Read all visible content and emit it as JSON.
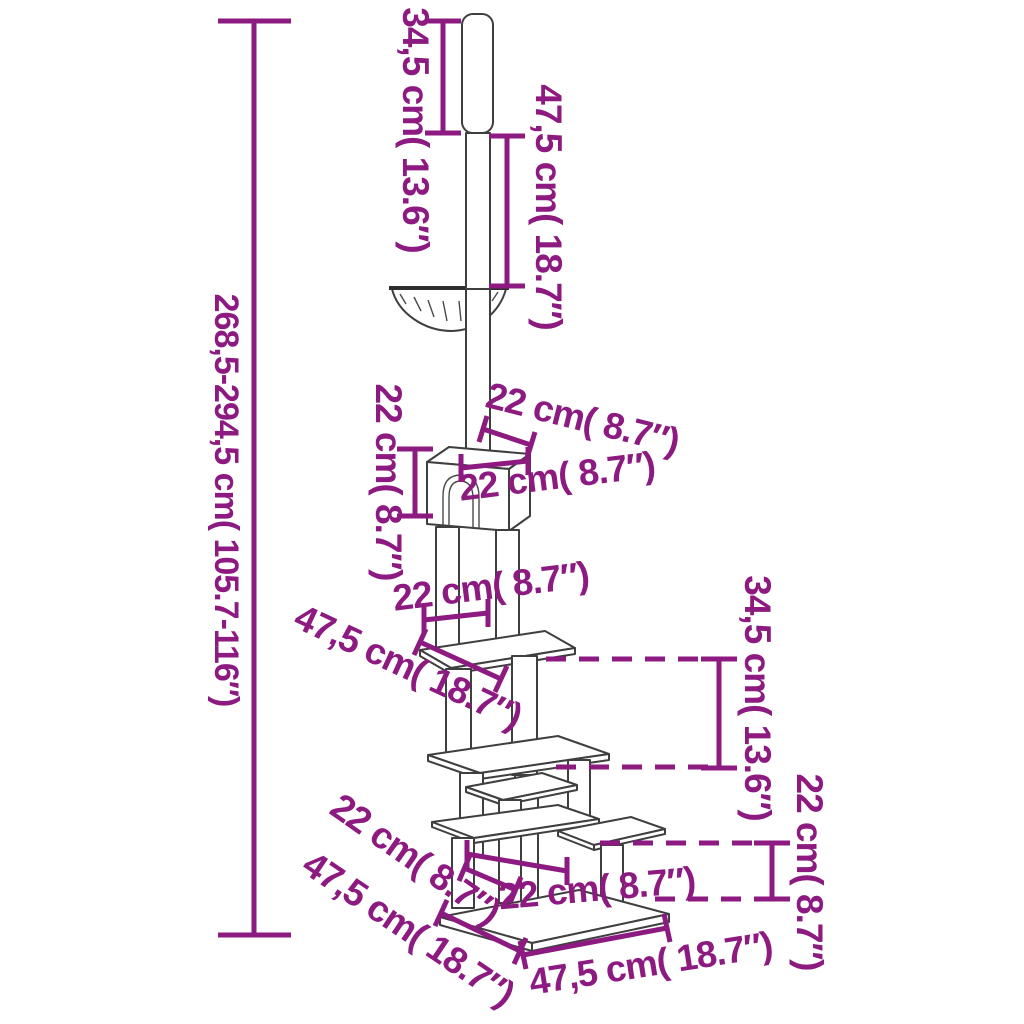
{
  "diagram": {
    "product": "floor-to-ceiling-cat-tree",
    "style": {
      "dimension_color": "#8d1a80",
      "outline_color": "#3f3f3f",
      "background": "#ffffff"
    },
    "dimensions": {
      "overall_height": {
        "text": "268,5-294,5 cm( 105.7-116″)",
        "cm": "268,5-294,5",
        "inches": "105.7-116"
      },
      "ceiling_tube_height": {
        "text": "34,5 cm( 13.6″)",
        "cm": "34,5",
        "inches": "13.6"
      },
      "upper_pole_height": {
        "text": "47,5 cm( 18.7″)",
        "cm": "47,5",
        "inches": "18.7"
      },
      "house_height": {
        "text": "22 cm( 8.7″)",
        "cm": "22",
        "inches": "8.7"
      },
      "house_top_depth": {
        "text": "22 cm( 8.7″)",
        "cm": "22",
        "inches": "8.7"
      },
      "house_front_width": {
        "text": "22 cm( 8.7″)",
        "cm": "22",
        "inches": "8.7"
      },
      "post_gap_below_house": {
        "text": "22 cm( 8.7″)",
        "cm": "22",
        "inches": "8.7"
      },
      "top_platform_width": {
        "text": "47,5 cm( 18.7″)",
        "cm": "47,5",
        "inches": "18.7"
      },
      "platform_level_gap": {
        "text": "34,5 cm( 13.6″)",
        "cm": "34,5",
        "inches": "13.6"
      },
      "lower_level_gap": {
        "text": "22 cm( 8.7″)",
        "cm": "22",
        "inches": "8.7"
      },
      "step_platform_depth": {
        "text": "22 cm( 8.7″)",
        "cm": "22",
        "inches": "8.7"
      },
      "base_depth": {
        "text": "47,5 cm( 18.7″)",
        "cm": "47,5",
        "inches": "18.7"
      },
      "step_platform_width": {
        "text": "22 cm( 8.7″)",
        "cm": "22",
        "inches": "8.7"
      },
      "base_width": {
        "text": "47,5 cm( 18.7″)",
        "cm": "47,5",
        "inches": "18.7"
      }
    }
  }
}
